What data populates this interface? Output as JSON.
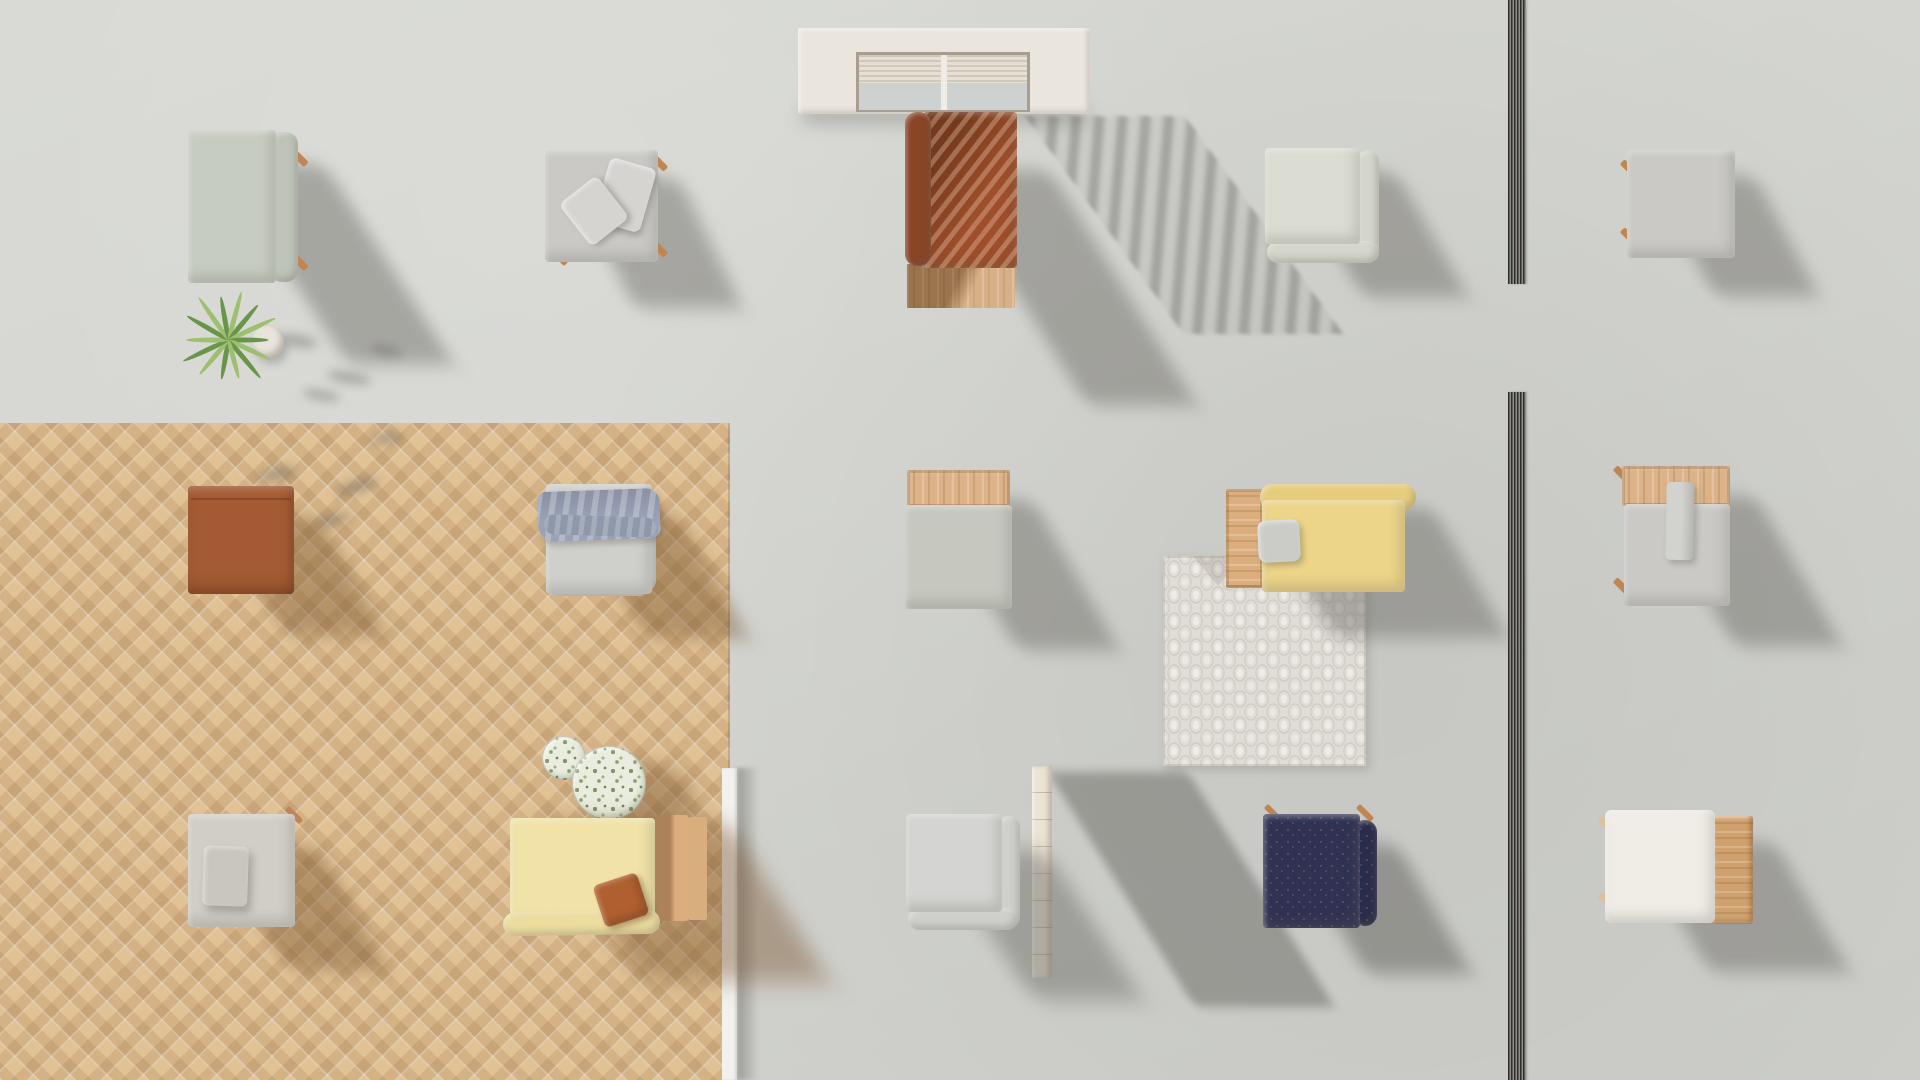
{
  "scene": {
    "title": "Top-down 3D render of an outdoor furniture showroom with concrete and herringbone parquet floors",
    "colors": {
      "concrete": "#d6d7d2",
      "wood_floor": "#e1c295",
      "white_wall": "#f2f1ed",
      "travertine": "#ebe3d4",
      "frame_white": "#eae5dd",
      "recess": "#a79e90",
      "blind": "#e6dfd2",
      "glass": "#cdd2d1",
      "mullion": "#efece6",
      "sage": "#c7ccc1",
      "sage_back": "#bec4b8",
      "sage_light": "#dbddd3",
      "sage_light_back": "#d3d6cb",
      "sage_cushion": "#c6c8c0",
      "gray_fabric": "#cac9c6",
      "gray_chair": "#cfcfcb",
      "gray_chair_back": "#c9c9c5",
      "gray_chair_b": "#d4d4d2",
      "gray_chair_b_back": "#cfcfcc",
      "back_piece": "#d2d2cf",
      "pillow_light": "#d6d4d1",
      "pillow_gray": "#cbccc8",
      "beige_base": "#d1cec6",
      "beige_pillow": "#c9c6be",
      "white_fabric": "#f0ede7",
      "rust": "#9d4e2a",
      "rust_dark": "#8a4426",
      "rust_leather": "#a45b33",
      "rust_pillow": "#b06030",
      "navy": "#303253",
      "navy_dark": "#2a2c4b",
      "yellow": "#ecd489",
      "yellow_bolster": "#e6cd7e",
      "yellow_pale": "#f1e3a7",
      "yellow_pale_bolster": "#ecdc9e",
      "blue_throw": "#9aa2b6",
      "blue_throw_dark": "#8f97aa",
      "wood_base": "#c99c6e",
      "wood_tray": "#dcb389",
      "side_table": "#dcae7e",
      "arm_wood": "#d9ae7d",
      "table_wood": "#cfa16e",
      "peg": "#c08552",
      "peg_light": "#dcc09a",
      "pot": "#e8e3db",
      "leaf": "#69954a",
      "leaf_light": "#9dbf70",
      "rug_base": "#e0dcd6",
      "terrazzo": "#eaecdf",
      "track": "#55544f"
    },
    "items": [
      {
        "name": "sage-bench",
        "floor": "concrete",
        "colors": [
          "#c7ccc1",
          "#bec4b8",
          "#c08552"
        ]
      },
      {
        "name": "potted-plant",
        "floor": "concrete",
        "colors": [
          "#69954a",
          "#9dbf70",
          "#e8e3db"
        ]
      },
      {
        "name": "gray-daybed-with-pillows",
        "floor": "concrete",
        "colors": [
          "#cac9c6",
          "#d6d4d1"
        ]
      },
      {
        "name": "patio-door-with-blinds",
        "floor": "concrete",
        "colors": [
          "#eae5dd",
          "#e6dfd2",
          "#cdd2d1"
        ]
      },
      {
        "name": "rust-sofa-on-wood-base",
        "floor": "concrete",
        "colors": [
          "#9d4e2a",
          "#8a4426",
          "#c99c6e"
        ]
      },
      {
        "name": "sage-corner-chair",
        "floor": "concrete",
        "colors": [
          "#dbddd3"
        ]
      },
      {
        "name": "gray-ottoman",
        "floor": "concrete",
        "colors": [
          "#cac9c6"
        ]
      },
      {
        "name": "rust-leather-cube",
        "floor": "wood",
        "colors": [
          "#a45b33"
        ]
      },
      {
        "name": "gray-chair-with-blue-throw",
        "floor": "wood",
        "colors": [
          "#cfcfcb",
          "#9aa2b6"
        ]
      },
      {
        "name": "sage-ottoman-with-wood-tray",
        "floor": "concrete",
        "colors": [
          "#c6c8c0",
          "#dcb389"
        ]
      },
      {
        "name": "yellow-daybed-with-side-table",
        "floor": "concrete",
        "colors": [
          "#ecd489",
          "#dcae7e",
          "#cbccc8"
        ]
      },
      {
        "name": "patterned-rug",
        "floor": "concrete",
        "colors": [
          "#e0dcd6"
        ]
      },
      {
        "name": "gray-chair-with-wood-tray",
        "floor": "concrete",
        "colors": [
          "#cac9c6",
          "#dcb389"
        ]
      },
      {
        "name": "beige-ottoman-with-pillow",
        "floor": "wood",
        "colors": [
          "#d1cec6",
          "#c9c6be"
        ]
      },
      {
        "name": "terrazzo-side-tables",
        "floor": "wood",
        "colors": [
          "#eaecdf",
          "#7d9867"
        ]
      },
      {
        "name": "pale-yellow-daybed-with-rust-pillow",
        "floor": "wood",
        "colors": [
          "#f1e3a7",
          "#b06030",
          "#dcae7e"
        ]
      },
      {
        "name": "gray-corner-chair",
        "floor": "concrete",
        "colors": [
          "#d4d4d2"
        ]
      },
      {
        "name": "travertine-wall-block",
        "floor": "concrete",
        "colors": [
          "#ebe3d4"
        ]
      },
      {
        "name": "navy-corner-chair",
        "floor": "concrete",
        "colors": [
          "#303253"
        ]
      },
      {
        "name": "white-ottoman-with-wood-table",
        "floor": "concrete",
        "colors": [
          "#f0ede7",
          "#cfa16e"
        ]
      },
      {
        "name": "white-partition-edge",
        "floor": "wood",
        "colors": [
          "#f2f1ed"
        ]
      },
      {
        "name": "floor-track-divider",
        "floor": "concrete",
        "colors": [
          "#55544f"
        ]
      }
    ]
  }
}
